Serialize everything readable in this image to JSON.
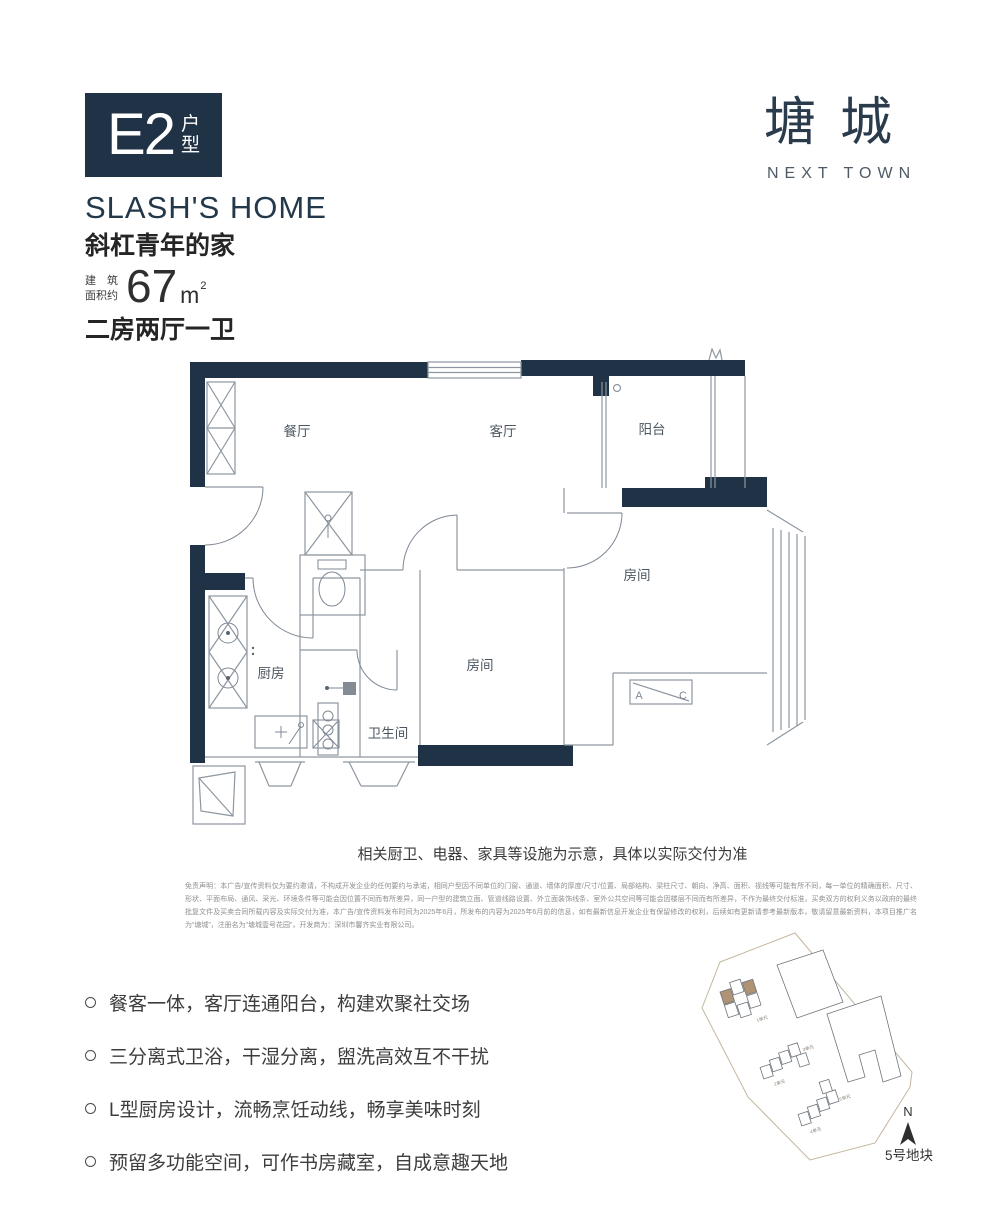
{
  "badge": {
    "code": "E2",
    "suffix_top": "户",
    "suffix_bottom": "型"
  },
  "headline": {
    "en": "SLASH'S HOME",
    "cn": "斜杠青年的家"
  },
  "area": {
    "label_line1": "建　筑",
    "label_line2": "面积约",
    "value": "67",
    "unit": "m",
    "exponent": "2"
  },
  "layout": "二房两厅一卫",
  "logo": {
    "cn": "塘城",
    "en": "NEXT TOWN"
  },
  "floorplan": {
    "dining": "餐厅",
    "living": "客厅",
    "balcony": "阳台",
    "bedroom_right": "房间",
    "bedroom_center": "房间",
    "kitchen": "厨房",
    "bathroom": "卫生间",
    "ac_a": "A",
    "ac_c": "C",
    "caption": "相关厨卫、电器、家具等设施为示意，具体以实际交付为准"
  },
  "disclaimer": "免责声明：本广告/宣传资料仅为要约邀请，不构成开发企业的任何要约与承诺，相同户型因不同单位的门窗、通道、墙体的厚度/尺寸/位置、局部结构、梁柱尺寸、朝向、净高、面积、视线等可能有所不同，每一单位的精确面积、尺寸、形状、平面布局、通风、采光、环境条件等可能会因位置不同而有所差异，同一户型的建筑立面、管道线路设置、外立面装饰线条、室外公共空间等可能会因楼层不同而有所差异，不作为最终交付标准，买卖双方的权利义务以政府的最终批复文件及买卖合同所载内容及实际交付为准，本广告/宣传资料发布时间为2025年6月，所发布的内容为2025年6月前的信息，如有最新信息开发企业有保留修改的权利，后续如有更新请参考最新版本，敬请留意最新资料，本项目推广名为“塘城”，注册名为“塘城壹号花园”，开发商为：深圳市馨齐实业有限公司。",
  "features": [
    "餐客一体，客厅连通阳台，构建欢聚社交场",
    "三分离式卫浴，干湿分离，盥洗高效互不干扰",
    "L型厨房设计，流畅烹饪动线，畅享美味时刻",
    "预留多功能空间，可作书房藏室，自成意趣天地"
  ],
  "siteplan": {
    "plot": "5号地块",
    "north": "N",
    "units": [
      "1单元",
      "2单元",
      "3单元",
      "4单元",
      "5单元"
    ]
  },
  "colors": {
    "navy": "#203346",
    "tan": "#b09274"
  }
}
